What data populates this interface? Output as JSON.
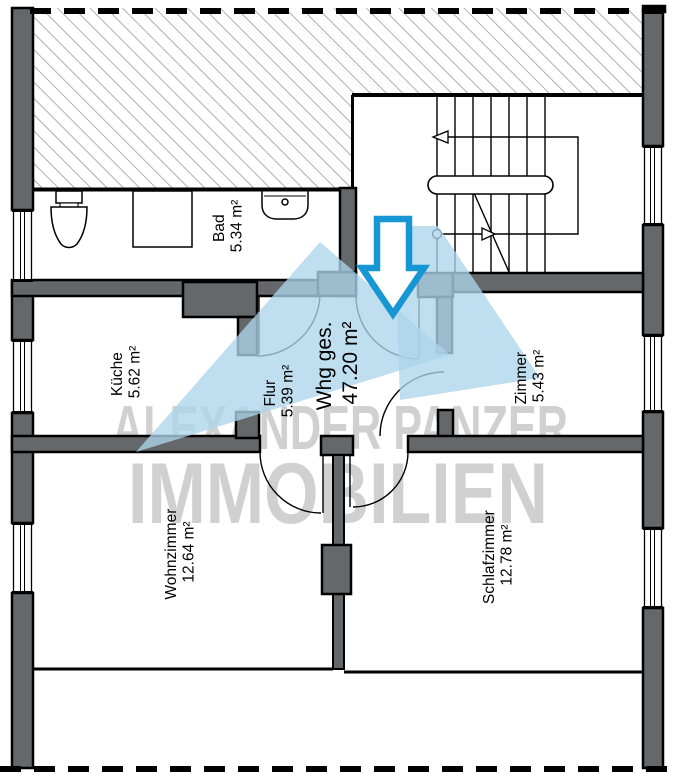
{
  "plan": {
    "watermark": {
      "line1": "ALEXANDER PANZER",
      "line2": "IMMOBILIEN"
    },
    "total_label": {
      "name": "Whg ges.",
      "area": "47.20 m²"
    },
    "rooms": [
      {
        "id": "bad",
        "name": "Bad",
        "area": "5.34 m²"
      },
      {
        "id": "kueche",
        "name": "Küche",
        "area": "5.62 m²"
      },
      {
        "id": "flur",
        "name": "Flur",
        "area": "5.39 m²"
      },
      {
        "id": "zimmer",
        "name": "Zimmer",
        "area": "5.43 m²"
      },
      {
        "id": "wohnzimmer",
        "name": "Wohnzimmer",
        "area": "12.64 m²"
      },
      {
        "id": "schlafzimmer",
        "name": "Schlafzimmer",
        "area": "12.78 m²"
      }
    ],
    "icons": [
      "toilet-icon",
      "shower-icon",
      "sink-icon",
      "staircase-icon",
      "entrance-arrow-icon",
      "camera-view-cone"
    ],
    "colors": {
      "wall": "#64686b",
      "outline": "#000000",
      "hatch_line": "#8d8d8d",
      "arrow_blue": "#1697d4",
      "view_cone_blue": "#add5ea",
      "watermark_gray": "#c8c8c8"
    }
  }
}
